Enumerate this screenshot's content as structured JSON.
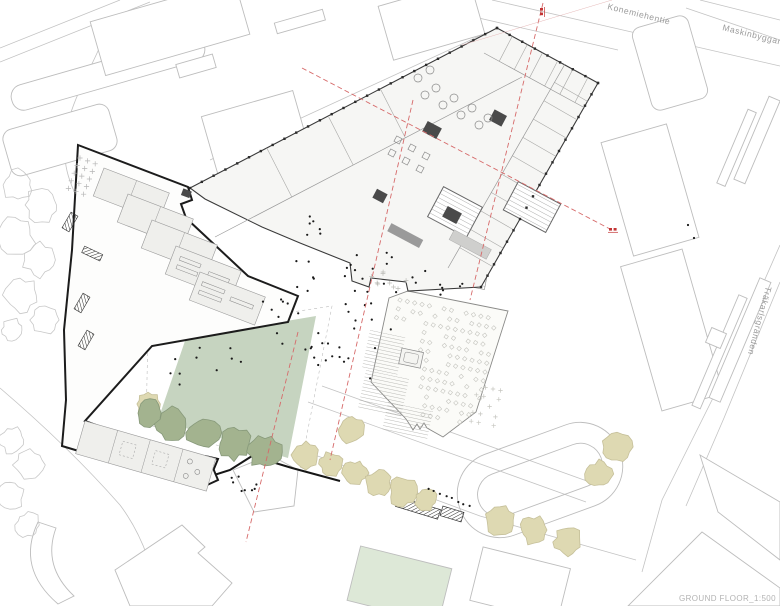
{
  "drawing": {
    "title_block": {
      "label": "GROUND FLOOR_1:500",
      "floor": "GROUND FLOOR",
      "scale": "1:500"
    },
    "streets": {
      "north": "Konemiehentie",
      "northeast": "Maskinbyggarvägen",
      "east": "Träkarlsgränden"
    },
    "colors": {
      "lawn": "#c6d4c0",
      "lawn_pale": "#dde8d7",
      "tree_green_fill": "#a3b38f",
      "tree_green_stroke": "#87997a",
      "tree_beige_fill": "#ded9b2",
      "tree_beige_stroke": "#c6c09a",
      "context_stroke": "#c3c3c3",
      "building_fill": "#f6f6f4",
      "room_fill": "#efefec",
      "annex_fill": "#fbfbf8",
      "wall_dark": "#1c1c1c",
      "outline": "#3a3a3a",
      "section_red": "#d66a6a",
      "marker_red": "#c33434",
      "label_gray": "#b3b3b3"
    }
  }
}
